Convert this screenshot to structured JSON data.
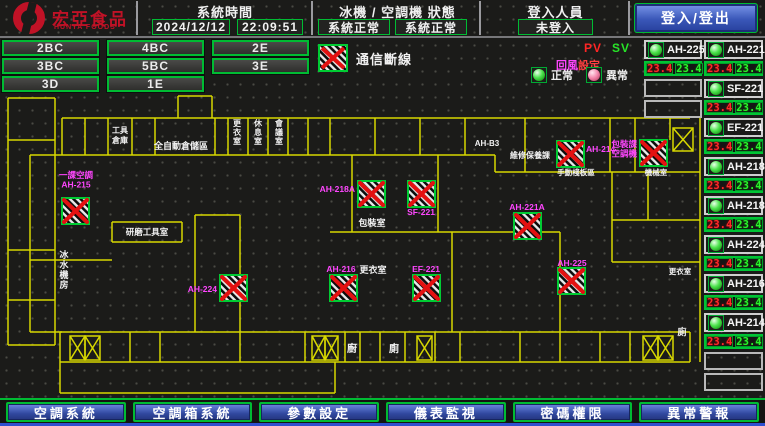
{
  "header": {
    "brand": "宏亞食品",
    "brand_sub": "HUNYA FOODS",
    "system_time": {
      "label": "系統時間",
      "date": "2024/12/12",
      "time": "22:09:51"
    },
    "machine_status": {
      "label": "冰機 / 空調機 狀態",
      "chiller": "系統正常",
      "ahu": "系統正常"
    },
    "login": {
      "label": "登入人員",
      "value": "未登入",
      "button": "登入/登出"
    }
  },
  "floor_rows": [
    [
      "2BC",
      "4BC",
      "2E"
    ],
    [
      "3BC",
      "5BC",
      "3E"
    ],
    [
      "3D",
      "1E"
    ]
  ],
  "legend": {
    "comm_loss": "通信斷線",
    "pv": "PV",
    "sv": "SV",
    "setting_1": "回風",
    "setting_2": "設定",
    "normal": "正常",
    "abnormal": "異常"
  },
  "equipment": {
    "colA": [
      {
        "name": "AH-225",
        "pv": "23.4",
        "sv": "23.4",
        "state": "normal"
      },
      {
        "empty": true
      },
      {
        "empty": true
      }
    ],
    "colB": [
      {
        "name": "AH-221A",
        "pv": "23.4",
        "sv": "23.4",
        "state": "normal"
      },
      {
        "name": "SF-221",
        "pv": "23.4",
        "sv": "23.4",
        "state": "normal"
      },
      {
        "name": "EF-221",
        "pv": "23.4",
        "sv": "23.4",
        "state": "normal"
      },
      {
        "name": "AH-218A",
        "pv": "23.4",
        "sv": "23.4",
        "state": "normal"
      },
      {
        "name": "AH-218B",
        "pv": "23.4",
        "sv": "23.4",
        "state": "normal"
      },
      {
        "name": "AH-224",
        "pv": "23.4",
        "sv": "23.4",
        "state": "normal"
      },
      {
        "name": "AH-216",
        "pv": "23.4",
        "sv": "23.4",
        "state": "normal"
      },
      {
        "name": "AH-214",
        "pv": "23.4",
        "sv": "23.4",
        "state": "normal"
      },
      {
        "empty": true
      },
      {
        "empty": true
      }
    ]
  },
  "nav": [
    {
      "label": "空調系統",
      "name": "nav-ac-system"
    },
    {
      "label": "空調箱系統",
      "name": "nav-ahu-system"
    },
    {
      "label": "參數設定",
      "name": "nav-parameter-settings"
    },
    {
      "label": "儀表監視",
      "name": "nav-meter-monitor"
    },
    {
      "label": "密碼權限",
      "name": "nav-password-authority"
    },
    {
      "label": "異常警報",
      "name": "nav-alarm"
    }
  ],
  "map": {
    "markers": [
      {
        "x": 62,
        "y": 198,
        "name": "AH-215",
        "label_lines": [
          "一課空調",
          "AH-215"
        ],
        "lx": 76,
        "ly": 178,
        "anchor": "middle"
      },
      {
        "x": 220,
        "y": 275,
        "name": "AH-224",
        "label_lines": [
          "AH-224"
        ],
        "lx": 217,
        "ly": 292,
        "anchor": "end"
      },
      {
        "x": 330,
        "y": 275,
        "name": "AH-216",
        "label_lines": [
          "AH-216"
        ],
        "lx": 341,
        "ly": 272,
        "anchor": "middle"
      },
      {
        "x": 413,
        "y": 275,
        "name": "EF-221",
        "label_lines": [
          "EF-221"
        ],
        "lx": 426,
        "ly": 272,
        "anchor": "middle"
      },
      {
        "x": 358,
        "y": 181,
        "name": "AH-218A",
        "label_lines": [
          "AH-218A"
        ],
        "lx": 355,
        "ly": 192,
        "anchor": "end"
      },
      {
        "x": 408,
        "y": 181,
        "name": "SF-221",
        "label_lines": [
          "SF-221"
        ],
        "lx": 421,
        "ly": 215,
        "anchor": "middle"
      },
      {
        "x": 514,
        "y": 213,
        "name": "AH-221A",
        "label_lines": [
          "AH-221A"
        ],
        "lx": 527,
        "ly": 210,
        "anchor": "middle"
      },
      {
        "x": 558,
        "y": 268,
        "name": "AH-225",
        "label_lines": [
          "AH-225"
        ],
        "lx": 572,
        "ly": 266,
        "anchor": "middle"
      },
      {
        "x": 557,
        "y": 141,
        "name": "AH-214",
        "label_lines": [
          "AH-214"
        ],
        "lx": 586,
        "ly": 152,
        "anchor": "start"
      },
      {
        "x": 640,
        "y": 140,
        "name": "AH-218B",
        "label_lines": [
          "包裝課",
          "空調機"
        ],
        "lx": 637,
        "ly": 147,
        "anchor": "end"
      }
    ],
    "labels": [
      {
        "t": "工具",
        "x": 120,
        "y": 133,
        "s": 8
      },
      {
        "t": "倉庫",
        "x": 120,
        "y": 143,
        "s": 8
      },
      {
        "t": "全自動倉儲區",
        "x": 181,
        "y": 149,
        "s": 9
      },
      {
        "t": "更衣室",
        "x": 237,
        "y": 126,
        "s": 8,
        "v": true
      },
      {
        "t": "休息室",
        "x": 258,
        "y": 126,
        "s": 8,
        "v": true
      },
      {
        "t": "會議室",
        "x": 279,
        "y": 126,
        "s": 8,
        "v": true
      },
      {
        "t": "AH-B3",
        "x": 487,
        "y": 146,
        "s": 8
      },
      {
        "t": "維修保養課",
        "x": 530,
        "y": 158,
        "s": 8
      },
      {
        "t": "手動棧板區",
        "x": 576,
        "y": 175,
        "s": 7.5
      },
      {
        "t": "機械室",
        "x": 656,
        "y": 175,
        "s": 7.5
      },
      {
        "t": "研磨工具室",
        "x": 147,
        "y": 235,
        "s": 8.5
      },
      {
        "t": "冰水機房",
        "x": 64,
        "y": 258,
        "s": 9,
        "v": true
      },
      {
        "t": "包裝室",
        "x": 372,
        "y": 226,
        "s": 9
      },
      {
        "t": "更衣室",
        "x": 373,
        "y": 273,
        "s": 9
      },
      {
        "t": "廚",
        "x": 352,
        "y": 352,
        "s": 10
      },
      {
        "t": "廁",
        "x": 394,
        "y": 352,
        "s": 10
      },
      {
        "t": "更衣室",
        "x": 680,
        "y": 274,
        "s": 7.5
      },
      {
        "t": "廁",
        "x": 682,
        "y": 335,
        "s": 9
      }
    ],
    "elevators": [
      {
        "x": 70,
        "y": 336,
        "w": 30,
        "h": 24,
        "cells": 2
      },
      {
        "x": 312,
        "y": 336,
        "w": 26,
        "h": 24,
        "cells": 2
      },
      {
        "x": 417,
        "y": 336,
        "w": 15,
        "h": 24,
        "cells": 1
      },
      {
        "x": 643,
        "y": 336,
        "w": 30,
        "h": 24,
        "cells": 2
      },
      {
        "x": 673,
        "y": 128,
        "w": 20,
        "h": 23,
        "cells": 1
      }
    ],
    "walls": [
      [
        62,
        118,
        690,
        118
      ],
      [
        30,
        155,
        495,
        155
      ],
      [
        495,
        155,
        495,
        172
      ],
      [
        495,
        172,
        700,
        172
      ],
      [
        62,
        118,
        62,
        155
      ],
      [
        85,
        118,
        85,
        155
      ],
      [
        108,
        118,
        108,
        155
      ],
      [
        132,
        118,
        132,
        155
      ],
      [
        155,
        118,
        155,
        155
      ],
      [
        215,
        118,
        215,
        155
      ],
      [
        228,
        118,
        228,
        155
      ],
      [
        248,
        118,
        248,
        155
      ],
      [
        268,
        118,
        268,
        155
      ],
      [
        288,
        118,
        288,
        155
      ],
      [
        308,
        118,
        308,
        155
      ],
      [
        330,
        118,
        330,
        155
      ],
      [
        375,
        118,
        375,
        155
      ],
      [
        420,
        118,
        420,
        155
      ],
      [
        465,
        118,
        465,
        155
      ],
      [
        525,
        118,
        525,
        172
      ],
      [
        610,
        118,
        610,
        172
      ],
      [
        635,
        118,
        635,
        172
      ],
      [
        670,
        118,
        670,
        140
      ],
      [
        8,
        98,
        8,
        345
      ],
      [
        55,
        98,
        55,
        345
      ],
      [
        8,
        98,
        55,
        98
      ],
      [
        8,
        140,
        55,
        140
      ],
      [
        8,
        250,
        55,
        250
      ],
      [
        8,
        300,
        55,
        300
      ],
      [
        8,
        345,
        55,
        345
      ],
      [
        30,
        155,
        30,
        332
      ],
      [
        30,
        332,
        62,
        332
      ],
      [
        30,
        260,
        112,
        260
      ],
      [
        178,
        96,
        212,
        96
      ],
      [
        178,
        96,
        178,
        118
      ],
      [
        212,
        96,
        212,
        118
      ],
      [
        195,
        215,
        195,
        332
      ],
      [
        240,
        215,
        240,
        332
      ],
      [
        195,
        215,
        240,
        215
      ],
      [
        112,
        222,
        182,
        222
      ],
      [
        112,
        242,
        182,
        242
      ],
      [
        112,
        222,
        112,
        242
      ],
      [
        182,
        222,
        182,
        242
      ],
      [
        352,
        155,
        352,
        232
      ],
      [
        438,
        155,
        438,
        232
      ],
      [
        330,
        232,
        560,
        232
      ],
      [
        452,
        232,
        452,
        332
      ],
      [
        560,
        232,
        560,
        332
      ],
      [
        612,
        172,
        612,
        262
      ],
      [
        700,
        118,
        700,
        362
      ],
      [
        612,
        262,
        700,
        262
      ],
      [
        612,
        220,
        700,
        220
      ],
      [
        648,
        172,
        648,
        220
      ],
      [
        60,
        332,
        690,
        332
      ],
      [
        60,
        362,
        690,
        362
      ],
      [
        60,
        332,
        60,
        362
      ],
      [
        130,
        332,
        130,
        362
      ],
      [
        160,
        332,
        160,
        362
      ],
      [
        240,
        332,
        240,
        362
      ],
      [
        305,
        332,
        305,
        362
      ],
      [
        345,
        332,
        345,
        362
      ],
      [
        360,
        332,
        360,
        362
      ],
      [
        380,
        332,
        380,
        362
      ],
      [
        405,
        332,
        405,
        362
      ],
      [
        435,
        332,
        435,
        362
      ],
      [
        460,
        332,
        460,
        362
      ],
      [
        520,
        332,
        520,
        362
      ],
      [
        560,
        332,
        560,
        362
      ],
      [
        600,
        332,
        600,
        362
      ],
      [
        630,
        332,
        630,
        362
      ],
      [
        690,
        332,
        690,
        362
      ],
      [
        60,
        362,
        60,
        393
      ],
      [
        60,
        393,
        335,
        393
      ],
      [
        335,
        362,
        335,
        393
      ]
    ]
  },
  "colors": {
    "accent_green": "#00bb33",
    "alarm_red": "#ee1111",
    "magenta": "#ff46ff",
    "wall_yellow": "#d8d800",
    "pv_red": "#ff2a2a",
    "sv_green": "#2bf32b",
    "button_blue": "#3a57b8",
    "brand_red": "#c01226"
  }
}
